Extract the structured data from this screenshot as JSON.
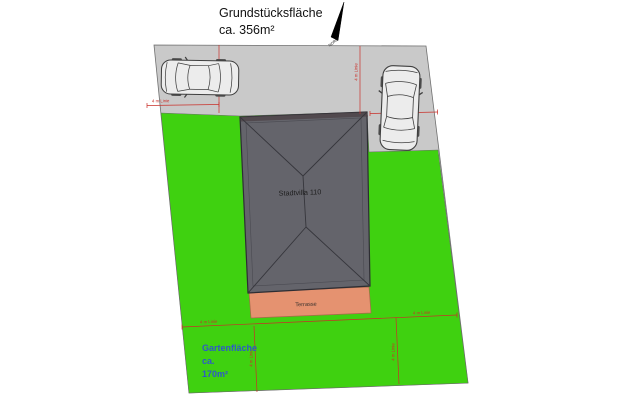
{
  "title": {
    "line1": "Grundstücksfläche",
    "line2": "ca. 356m²"
  },
  "north": {
    "label": "NORD"
  },
  "plan": {
    "house_label": "Stadtvilla 110",
    "terrace_label": "Terrasse",
    "garden": {
      "line1": "Gartenfläche",
      "line2": "ca.",
      "line3": "170m²"
    },
    "setback_label": "4 m Linie"
  },
  "colors": {
    "driveway_gray": "#c9c9c9",
    "grass_green": "#3fd110",
    "roof_gray": "#64646b",
    "roof_line": "#36363c",
    "terrace_salmon": "#e59270",
    "setback_red": "#c9302a",
    "garden_text_blue": "#2e59c9",
    "north_arrow_black": "#000000"
  }
}
